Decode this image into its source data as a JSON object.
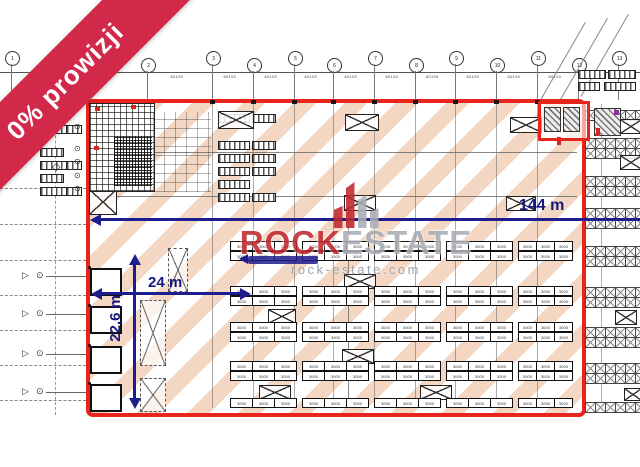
{
  "ribbon": {
    "label": "0% prowizji",
    "color": "#d2294b"
  },
  "watermark": {
    "brand_left": "ROCK",
    "brand_right": "ESTATE",
    "url": "rock-estate.com",
    "brand_left_color": "#c0272d",
    "brand_right_color": "#a9adb5"
  },
  "dimensions": {
    "width_label": "144 m",
    "bay_label": "24 m",
    "depth_label": "22,6 m",
    "color": "#1d1d8f"
  },
  "outline_color": "#e8251d",
  "stripe_color": "#f3d7c2",
  "grid": {
    "bubbles": [
      "1",
      "2",
      "3",
      "4",
      "5",
      "6",
      "7",
      "8",
      "9",
      "10",
      "11",
      "12",
      "13"
    ],
    "bay_text": "60100"
  },
  "racks": {
    "cell_label": "3000"
  },
  "symbols": {
    "dock_triangle": "▷",
    "dock_circle": "⊙",
    "diamond": "◇"
  }
}
